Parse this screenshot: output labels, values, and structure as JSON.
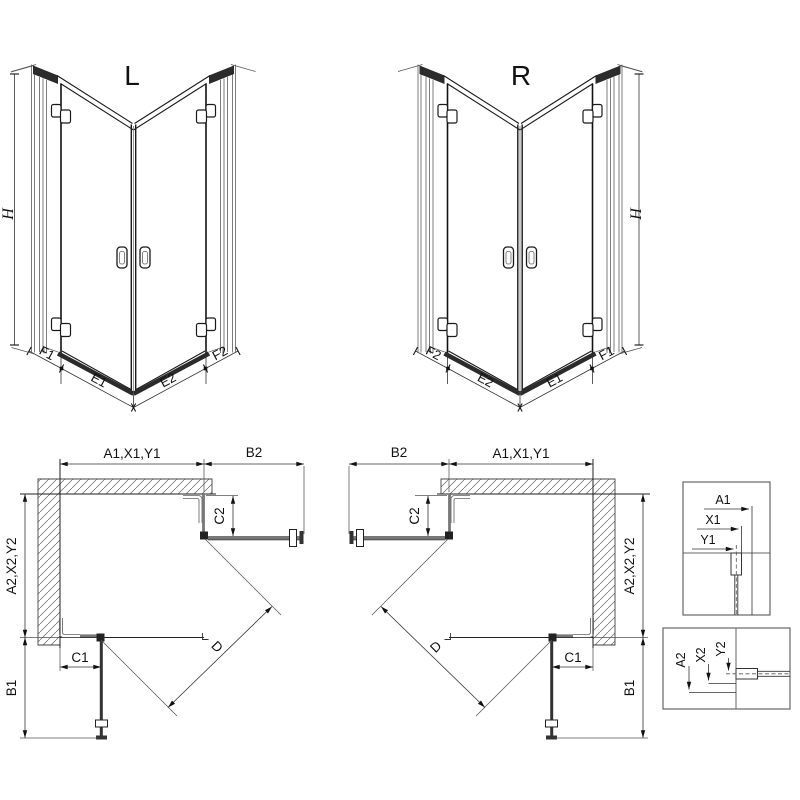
{
  "views": {
    "front_left": {
      "title": "L",
      "height": "H",
      "widths": [
        "F1",
        "E1",
        "E2",
        "F2"
      ]
    },
    "front_right": {
      "title": "R",
      "height": "H",
      "widths": [
        "F2",
        "E2",
        "E1",
        "F1"
      ]
    },
    "plan_left": {
      "width_top": "A1,X1,Y1",
      "door_top_projection": "B2",
      "c2": "C2",
      "depth_side": "A2,X2,Y2",
      "c1": "C1",
      "door_side_projection": "B1",
      "entry_diagonal": "D"
    },
    "plan_right": {
      "width_top": "A1,X1,Y1",
      "door_top_projection": "B2",
      "c2": "C2",
      "depth_side": "A2,X2,Y2",
      "c1": "C1",
      "door_side_projection": "B1",
      "entry_diagonal": "D"
    },
    "detail_width": {
      "a": "A1",
      "x": "X1",
      "y": "Y1"
    },
    "detail_depth": {
      "a": "A2",
      "x": "X2",
      "y": "Y2"
    }
  },
  "colors": {
    "background": "#ffffff",
    "line": "#1a1a1a",
    "secondary_line": "#555555",
    "glass_bar": "#777777",
    "dark_bar": "#2b2b2b"
  }
}
